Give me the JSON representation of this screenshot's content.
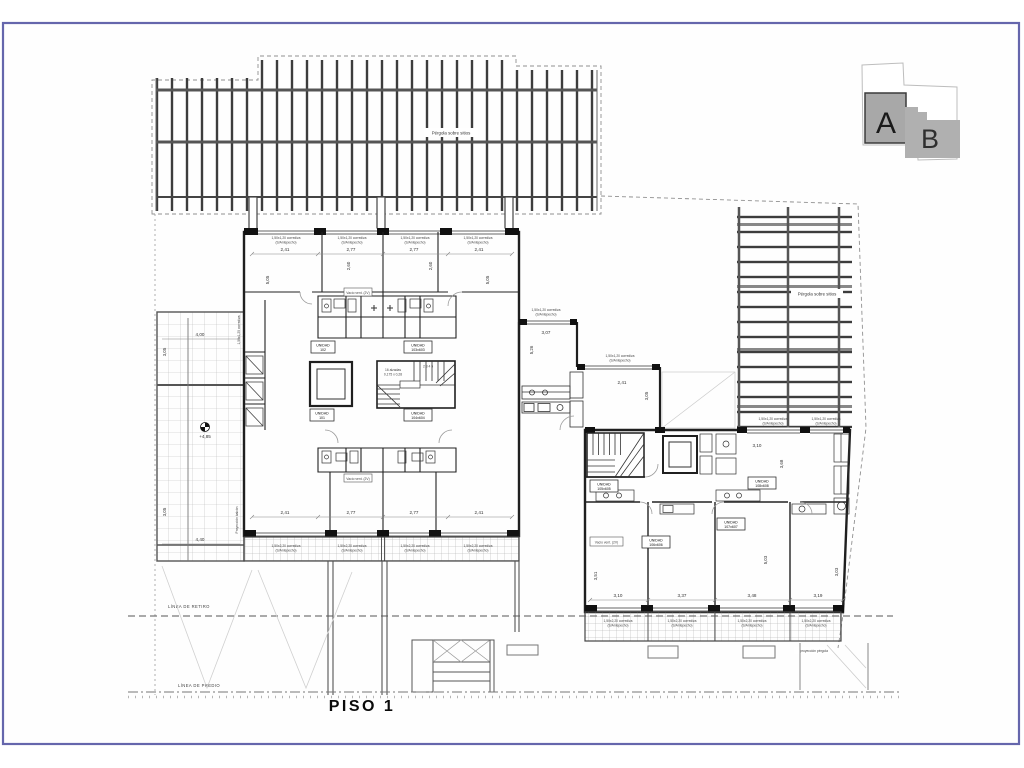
{
  "page": {
    "floor_label": "PISO 1"
  },
  "site": {
    "linea_retiro": "LÍNEA DE RETIRO",
    "linea_predio": "LÍNEA DE PREDIO"
  },
  "keyplan": {
    "a": "A",
    "b": "B"
  },
  "pergola": {
    "label": "Pérgola sobre sitios",
    "proyeccion": "proyección pérgola"
  },
  "terrace": {
    "proyeccion_balcon": "Proyección balcón",
    "nivel": "+4,85",
    "dim_top": "4,00",
    "dim_bottom": "4,40",
    "dim_v_top": "3,05",
    "dim_v_bottom": "3,05"
  },
  "unit_word": "UNIDAD",
  "building_a": {
    "units": [
      "102",
      "103x603",
      "101",
      "104x604"
    ],
    "dims_top": [
      "2,41",
      "2,77",
      "2,77",
      "2,41"
    ],
    "dims_bottom": [
      "2,41",
      "2,77",
      "2,77",
      "2,41"
    ],
    "dims_center": [
      "2,60",
      "2,60"
    ],
    "dim_side_left": "5,05",
    "dim_side_right": "5,05",
    "vent_label": "Vacío vent. (2V)",
    "stair_line1": "16 alzadas",
    "stair_line2": "0,175 x 0,28",
    "steps": "2 3 4 5",
    "window_label_l1": "1,50x1,20 corrediza",
    "window_label_l2": "(S/Antepecho)",
    "balcony_label_l1": "1,50x2,20 corrediza",
    "balcony_label_l2": "(S/Antepecho)"
  },
  "building_b": {
    "units": [
      "105x605",
      "106x606",
      "107x607",
      "108x608"
    ],
    "dims_bottom": [
      "3,10",
      "3,37",
      "3,48",
      "3,19"
    ],
    "dim_1": "3,07",
    "dim_2": "2,41",
    "dim_3": "3,10",
    "dim_v1": "5,26",
    "dim_v2": "3,05",
    "dim_v3": "5,03",
    "dim_v4": "3,51",
    "dim_v5": "3,03",
    "dim_v6": "3,68",
    "vent_label": "Vacío vent. (2V)"
  }
}
